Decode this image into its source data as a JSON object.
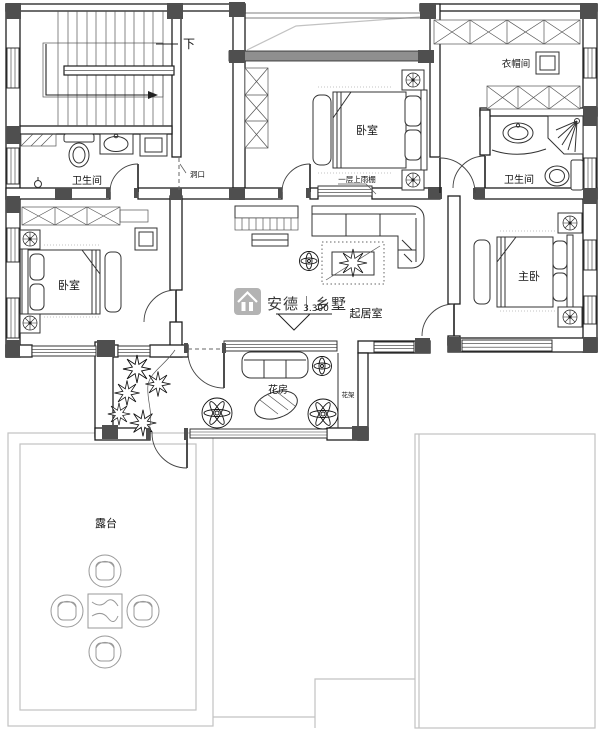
{
  "plan": {
    "rooms": {
      "stairs_down": "下",
      "bath_left": "卫生间",
      "bedroom_top": "卧室",
      "cloakroom": "衣帽间",
      "bath_right": "卫生间",
      "bedroom_left": "卧室",
      "master_bedroom": "主卧",
      "living_room": "起居室",
      "flower_room": "花房",
      "flower_rack": "花架",
      "terrace": "露台"
    },
    "annotations": {
      "wall_opening": "洞口",
      "canopy_note": "一层上雨棚",
      "elevation_value": "3.300"
    },
    "watermark": {
      "brand_text": "安德｜乡墅"
    },
    "colors": {
      "wall": "#1f1f1f",
      "column_fill": "#4f4f4f",
      "roof_outline": "#c2c2c2",
      "watermark": "#b4b8ae",
      "paper": "#ffffff"
    }
  }
}
